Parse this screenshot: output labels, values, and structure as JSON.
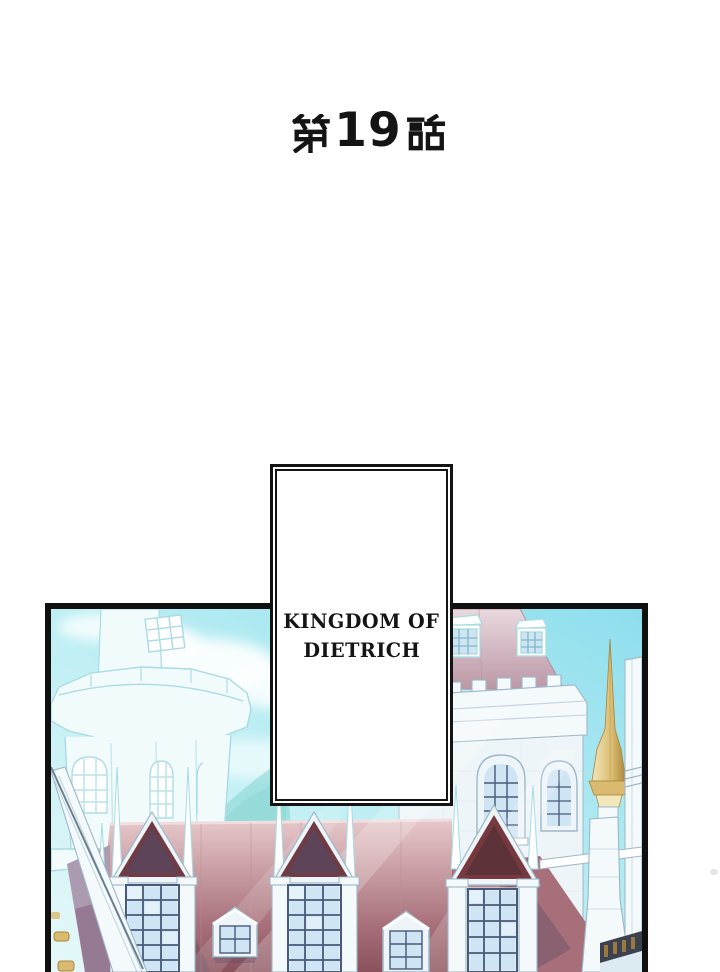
{
  "title": {
    "text": "第19話",
    "prefix_kanji": "第",
    "number": "19",
    "suffix_kanji": "話"
  },
  "caption": {
    "line1": "KINGDOM OF",
    "line2": "DIETRICH"
  },
  "panel": {
    "description": "Pale cyan-washed castle of the Kingdom of Dietrich: faint round bastion tower on the left, mauve-roofed keep with crenellated parapet and arched windows on the right, a golden spire, red rooftops with gabled dormer windows along the bottom, under a bright cyan sky with white clouds."
  },
  "colors": {
    "ink": "#141414",
    "panel_border": "#101010",
    "sky_deep": "#8edeed",
    "sky_mid": "#bceef3",
    "sky_light": "#e6f8f9",
    "cloud": "#ffffff",
    "hill_teal": "#7fd2cd",
    "line_faint": "#a9dbe3",
    "fill_faint": "#f2fbfc",
    "stone_white": "#f4f9fb",
    "stone_line": "#9db7c7",
    "stone_shadow": "#dcebf1",
    "roof_mauve": "#bb97a6",
    "roof_mauve_light": "#ead9de",
    "roof_red": "#a76f79",
    "roof_red_light": "#e6c8ca",
    "roof_red_dark": "#8a525c",
    "gable_maroon": "#6f3c45",
    "center_gable": "#76393f",
    "gable_shadow": "#574760",
    "window_grid": "#48597a",
    "window_pane": "#cfe5f3",
    "window_frame": "#eef5f9",
    "gold_light": "#f2e6bb",
    "gold": "#d9ba6e",
    "gold_dark": "#a8853e",
    "wall_mauve": "#b295a6",
    "wall_mauve_dark": "#8f7390",
    "rail_dark": "#3c4150",
    "artifact_gray": "#c9c9c9"
  }
}
